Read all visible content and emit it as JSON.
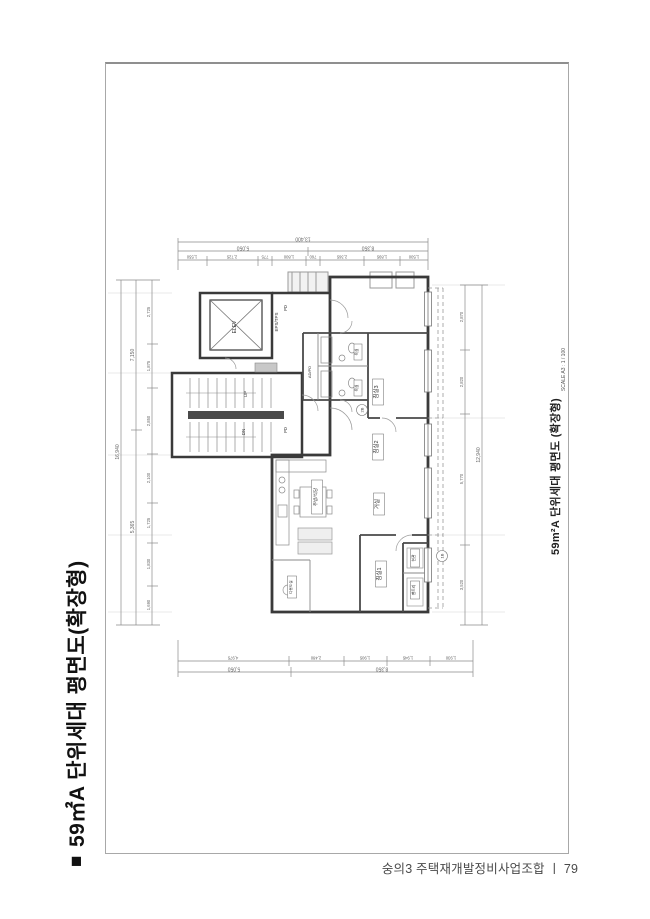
{
  "colors": {
    "wall": "#3a3a3a",
    "dim_line": "#8a8a8a",
    "text": "#444444",
    "frame": "#a8a8a8"
  },
  "sidebar_title": {
    "marker": "■",
    "text": "59㎡A 단위세대 평면도(확장형)"
  },
  "footer": {
    "org": "숭의3 주택재개발정비사업조합",
    "separator": "ㅣ",
    "page_number": "79"
  },
  "caption": {
    "title": "59m²A 단위세대 평면도 (확장형)",
    "scale": "SCALE A3 : 1 / 100",
    "symbol_number": "1",
    "symbol_sheet": "A3"
  },
  "plan": {
    "core": {
      "elevator": "ELEV",
      "shaft": "EPS/TPS",
      "stair_up": "UP",
      "stair_down": "DN",
      "duct_top": "PD",
      "duct_bottom": "PD",
      "duct_main": "AD/PD"
    },
    "rooms": {
      "bedroom3": "침실3",
      "bedroom2": "침실2",
      "bedroom1": "침실1",
      "living": "거실",
      "kitchen": "주방/식당",
      "bath1": "욕실",
      "bath2": "욕실",
      "entrance": "현관",
      "pantry": "팬트리",
      "utility": "다용도실"
    },
    "tags": {
      "tag1": "2B",
      "tag2": "1B"
    },
    "dims": {
      "top": {
        "total": "13,400",
        "groups": [
          "5,050",
          "8,350"
        ],
        "segments": [
          "1,550",
          "2,725",
          "775",
          "1,800",
          "760",
          "2,365",
          "1,895",
          "1,500"
        ]
      },
      "bottom": {
        "groups": [
          "5,050",
          "8,350"
        ],
        "segments": [
          "4,975",
          "2,480",
          "1,905",
          "1,945",
          "1,930"
        ]
      },
      "left": {
        "total": "16,940",
        "groups": [
          "7,150",
          "5,365"
        ],
        "segments": [
          "2,725",
          "1,875",
          "2,850",
          "2,100",
          "1,725",
          "1,830",
          "1,690"
        ]
      },
      "right": {
        "total": "12,940",
        "segments": [
          "2,870",
          "2,820",
          "5,770",
          "3,520"
        ]
      }
    }
  }
}
